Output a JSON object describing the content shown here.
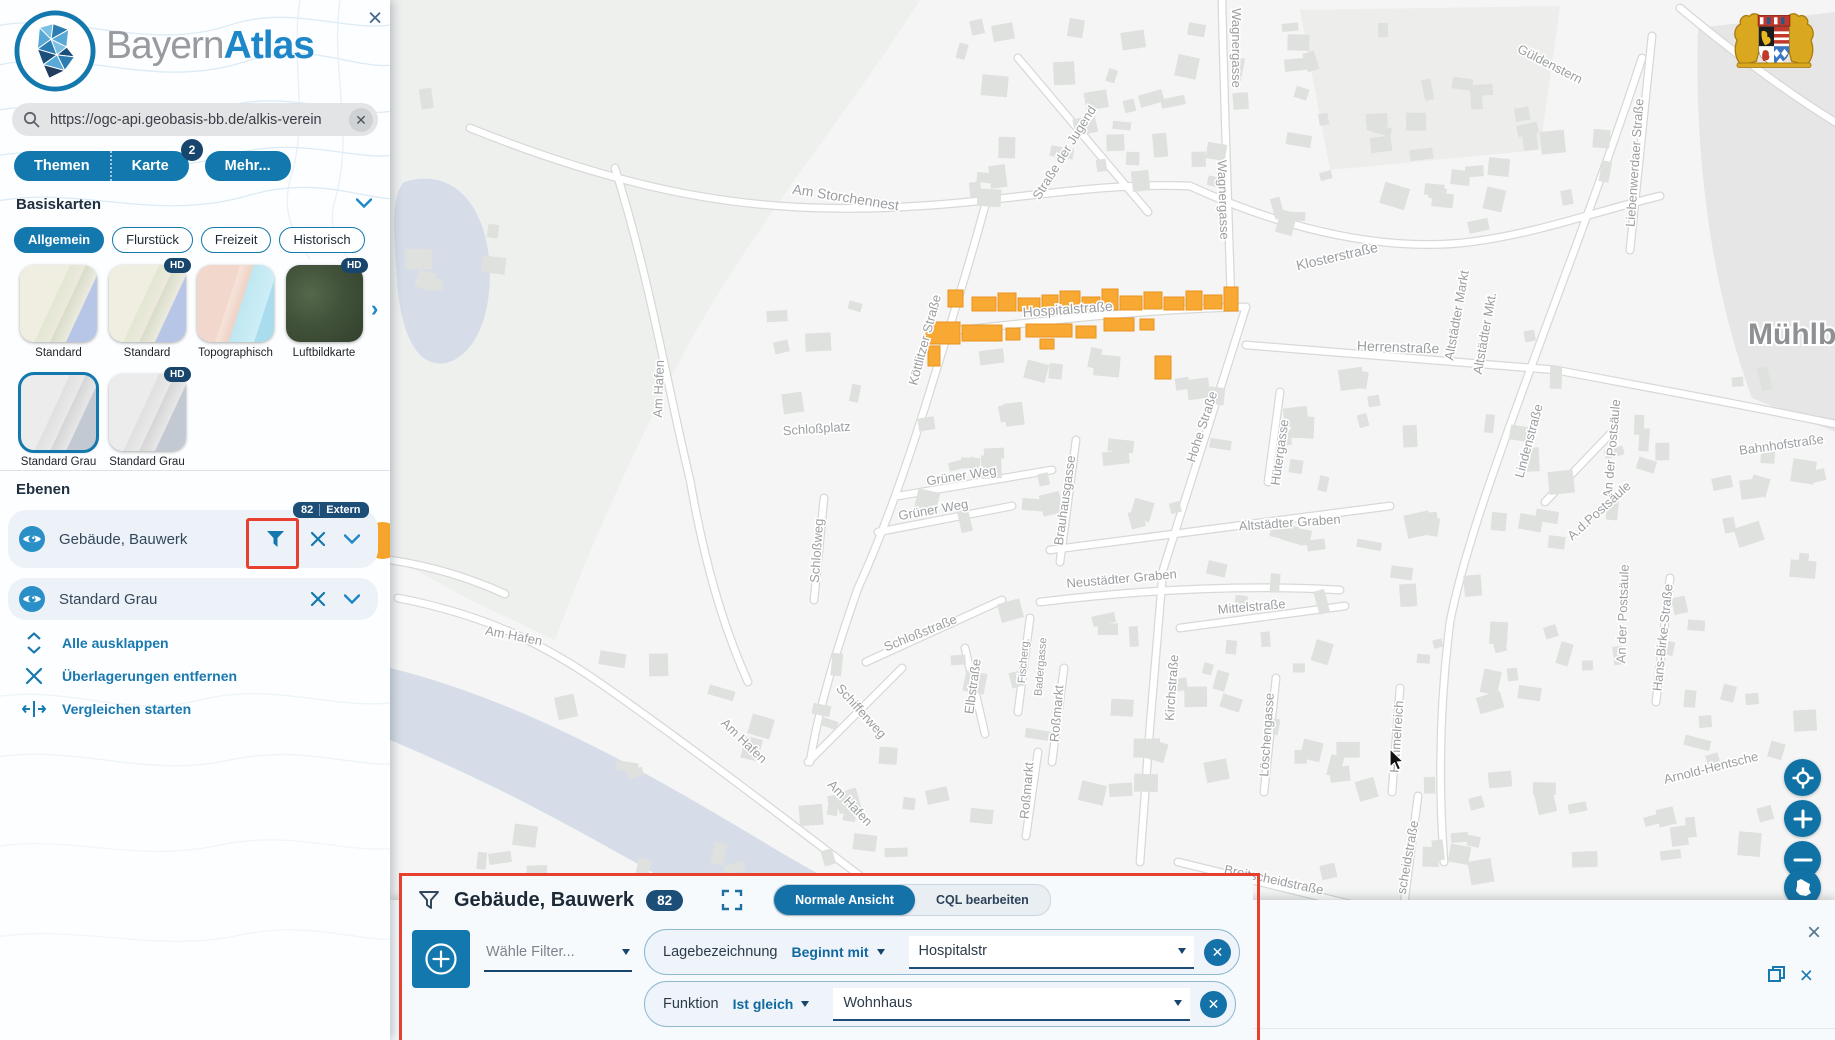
{
  "sidebar": {
    "logo": {
      "light": "Bayern",
      "bold": "Atlas"
    },
    "close_label": "×",
    "search": {
      "value": "https://ogc-api.geobasis-bb.de/alkis-verein"
    },
    "nav": {
      "themen": "Themen",
      "karte": "Karte",
      "karte_badge": "2",
      "mehr": "Mehr..."
    },
    "basiskarten": {
      "heading": "Basiskarten",
      "tabs": [
        {
          "label": "Allgemein",
          "active": true
        },
        {
          "label": "Flurstück",
          "active": false
        },
        {
          "label": "Freizeit",
          "active": false
        },
        {
          "label": "Historisch",
          "active": false
        }
      ],
      "thumbs": [
        {
          "label": "Standard",
          "hd": false,
          "style": "standard",
          "selected": false,
          "row": 0,
          "col": 0
        },
        {
          "label": "Standard",
          "hd": true,
          "style": "standard",
          "selected": false,
          "row": 0,
          "col": 1
        },
        {
          "label": "Topographisch",
          "hd": false,
          "style": "topo",
          "selected": false,
          "row": 0,
          "col": 2
        },
        {
          "label": "Luftbildkarte",
          "hd": true,
          "style": "aerial",
          "selected": false,
          "row": 0,
          "col": 3
        },
        {
          "label": "Standard Grau",
          "hd": false,
          "style": "gray",
          "selected": true,
          "row": 1,
          "col": 0
        },
        {
          "label": "Standard Grau",
          "hd": true,
          "style": "gray",
          "selected": false,
          "row": 1,
          "col": 1
        }
      ]
    },
    "ebenen": {
      "heading": "Ebenen",
      "layers": [
        {
          "label": "Gebäude, Bauwerk",
          "badge_count": "82",
          "badge_label": "Extern"
        },
        {
          "label": "Standard Grau"
        }
      ],
      "actions": [
        {
          "label": "Alle ausklappen",
          "icon": "unfold-icon"
        },
        {
          "label": "Überlagerungen entfernen",
          "icon": "close-icon"
        },
        {
          "label": "Vergleichen starten",
          "icon": "compare-icon"
        }
      ]
    }
  },
  "map": {
    "town_label": "Mühlberg",
    "highlight_color": "#f7a933",
    "water_color": "#d6dde8",
    "labels": [
      {
        "t": "Wagnergasse",
        "x": 1232,
        "y": 48,
        "r": 90
      },
      {
        "t": "Wagnergasse",
        "x": 1219,
        "y": 200,
        "r": 88
      },
      {
        "t": "Straße der Jugend",
        "x": 1068,
        "y": 155,
        "r": -58
      },
      {
        "t": "Am Storchennest",
        "x": 845,
        "y": 202,
        "r": 9,
        "s": 14
      },
      {
        "t": "Köttlitzer Straße",
        "x": 929,
        "y": 341,
        "r": -75
      },
      {
        "t": "Hospitalstraße",
        "x": 1068,
        "y": 314,
        "r": -4,
        "s": 14
      },
      {
        "t": "Klosterstraße",
        "x": 1338,
        "y": 261,
        "r": -13,
        "s": 14
      },
      {
        "t": "Herrenstraße",
        "x": 1398,
        "y": 352,
        "r": 2,
        "s": 14
      },
      {
        "t": "Güldenstern",
        "x": 1548,
        "y": 68,
        "r": 27
      },
      {
        "t": "Liebenwerdaer Straße",
        "x": 1639,
        "y": 163,
        "r": -86
      },
      {
        "t": "Altstädter Markt",
        "x": 1461,
        "y": 316,
        "r": -80
      },
      {
        "t": "Altstädter Mkt.",
        "x": 1489,
        "y": 334,
        "r": -80
      },
      {
        "t": "Lindenstraße",
        "x": 1533,
        "y": 442,
        "r": -75
      },
      {
        "t": "Bahnhofstraße",
        "x": 1782,
        "y": 449,
        "r": -8
      },
      {
        "t": "An der Postsäule",
        "x": 1616,
        "y": 449,
        "r": -85
      },
      {
        "t": "A.d.Postsäule",
        "x": 1602,
        "y": 514,
        "r": -42
      },
      {
        "t": "An der Postsäule",
        "x": 1627,
        "y": 614,
        "r": -88
      },
      {
        "t": "Hans-Birke-Straße",
        "x": 1667,
        "y": 638,
        "r": -84
      },
      {
        "t": "Arnold-Hentsche",
        "x": 1712,
        "y": 772,
        "r": -14
      },
      {
        "t": "Hütergasse",
        "x": 1284,
        "y": 453,
        "r": -82
      },
      {
        "t": "Hohe Straße",
        "x": 1206,
        "y": 428,
        "r": -72
      },
      {
        "t": "Altstädter Graben",
        "x": 1290,
        "y": 527,
        "r": -4
      },
      {
        "t": "Neustädter Graben",
        "x": 1122,
        "y": 583,
        "r": -5
      },
      {
        "t": "Mittelstraße",
        "x": 1252,
        "y": 611,
        "r": -5
      },
      {
        "t": "Kirchstraße",
        "x": 1176,
        "y": 688,
        "r": -86
      },
      {
        "t": "Löschengasse",
        "x": 1271,
        "y": 735,
        "r": -86
      },
      {
        "t": "Breitscheidstraße",
        "x": 1273,
        "y": 884,
        "r": 12
      },
      {
        "t": "scheidstraße",
        "x": 1412,
        "y": 858,
        "r": -80
      },
      {
        "t": "Himmelreich",
        "x": 1401,
        "y": 737,
        "r": -86
      },
      {
        "t": "Brauhausgasse",
        "x": 1069,
        "y": 501,
        "r": -82
      },
      {
        "t": "Grüner Weg",
        "x": 962,
        "y": 480,
        "r": -9
      },
      {
        "t": "Grüner Weg",
        "x": 934,
        "y": 514,
        "r": -10
      },
      {
        "t": "Schloßplatz",
        "x": 817,
        "y": 433,
        "r": -4
      },
      {
        "t": "Schloßweg",
        "x": 821,
        "y": 551,
        "r": -86
      },
      {
        "t": "Schloßstraße",
        "x": 922,
        "y": 637,
        "r": -22
      },
      {
        "t": "Fischerg.",
        "x": 1027,
        "y": 661,
        "r": -85,
        "s": 11
      },
      {
        "t": "Badergasse",
        "x": 1044,
        "y": 667,
        "r": -85,
        "s": 11
      },
      {
        "t": "Roßmarkt",
        "x": 1061,
        "y": 714,
        "r": -85
      },
      {
        "t": "Roßmarkt",
        "x": 1031,
        "y": 791,
        "r": -85
      },
      {
        "t": "Schifferweg",
        "x": 858,
        "y": 714,
        "r": 48
      },
      {
        "t": "Elbstraße",
        "x": 977,
        "y": 687,
        "r": -82
      },
      {
        "t": "Am Hafen",
        "x": 513,
        "y": 640,
        "r": 11
      },
      {
        "t": "Am Hafen",
        "x": 663,
        "y": 389,
        "r": -88
      },
      {
        "t": "Am Hafen",
        "x": 741,
        "y": 744,
        "r": 44
      },
      {
        "t": "Am Hafen",
        "x": 847,
        "y": 806,
        "r": 46
      }
    ],
    "orange_buildings": [
      [
        948,
        290,
        15,
        17
      ],
      [
        972,
        297,
        24,
        14
      ],
      [
        998,
        293,
        18,
        18
      ],
      [
        1018,
        298,
        22,
        13
      ],
      [
        1042,
        295,
        16,
        16
      ],
      [
        1060,
        291,
        20,
        20
      ],
      [
        1082,
        297,
        18,
        13
      ],
      [
        1102,
        289,
        16,
        21
      ],
      [
        1120,
        296,
        22,
        14
      ],
      [
        1144,
        292,
        18,
        17
      ],
      [
        1164,
        297,
        20,
        13
      ],
      [
        1186,
        291,
        16,
        19
      ],
      [
        1204,
        295,
        18,
        14
      ],
      [
        1224,
        287,
        14,
        24
      ],
      [
        926,
        322,
        34,
        22
      ],
      [
        928,
        346,
        12,
        20
      ],
      [
        962,
        325,
        40,
        16
      ],
      [
        1006,
        328,
        14,
        12
      ],
      [
        1026,
        324,
        46,
        13
      ],
      [
        1040,
        339,
        14,
        10
      ],
      [
        1076,
        326,
        20,
        12
      ],
      [
        1104,
        318,
        30,
        13
      ],
      [
        1140,
        319,
        14,
        11
      ],
      [
        1155,
        356,
        16,
        23
      ]
    ],
    "controls": [
      "geolocate",
      "zoom-in",
      "zoom-out",
      "bavaria-extent"
    ]
  },
  "panel": {
    "title": "Gebäude, Bauwerk",
    "count": "82",
    "view_toggle": [
      {
        "label": "Normale Ansicht",
        "active": true
      },
      {
        "label": "CQL bearbeiten",
        "active": false
      }
    ],
    "choose_filter": "Wähle Filter...",
    "filters": [
      {
        "field": "Lagebezeichnung",
        "op": "Beginnt mit",
        "value": "Hospitalstr"
      },
      {
        "field": "Funktion",
        "op": "Ist gleich",
        "value": "Wohnhaus"
      }
    ],
    "close_label": "×"
  }
}
